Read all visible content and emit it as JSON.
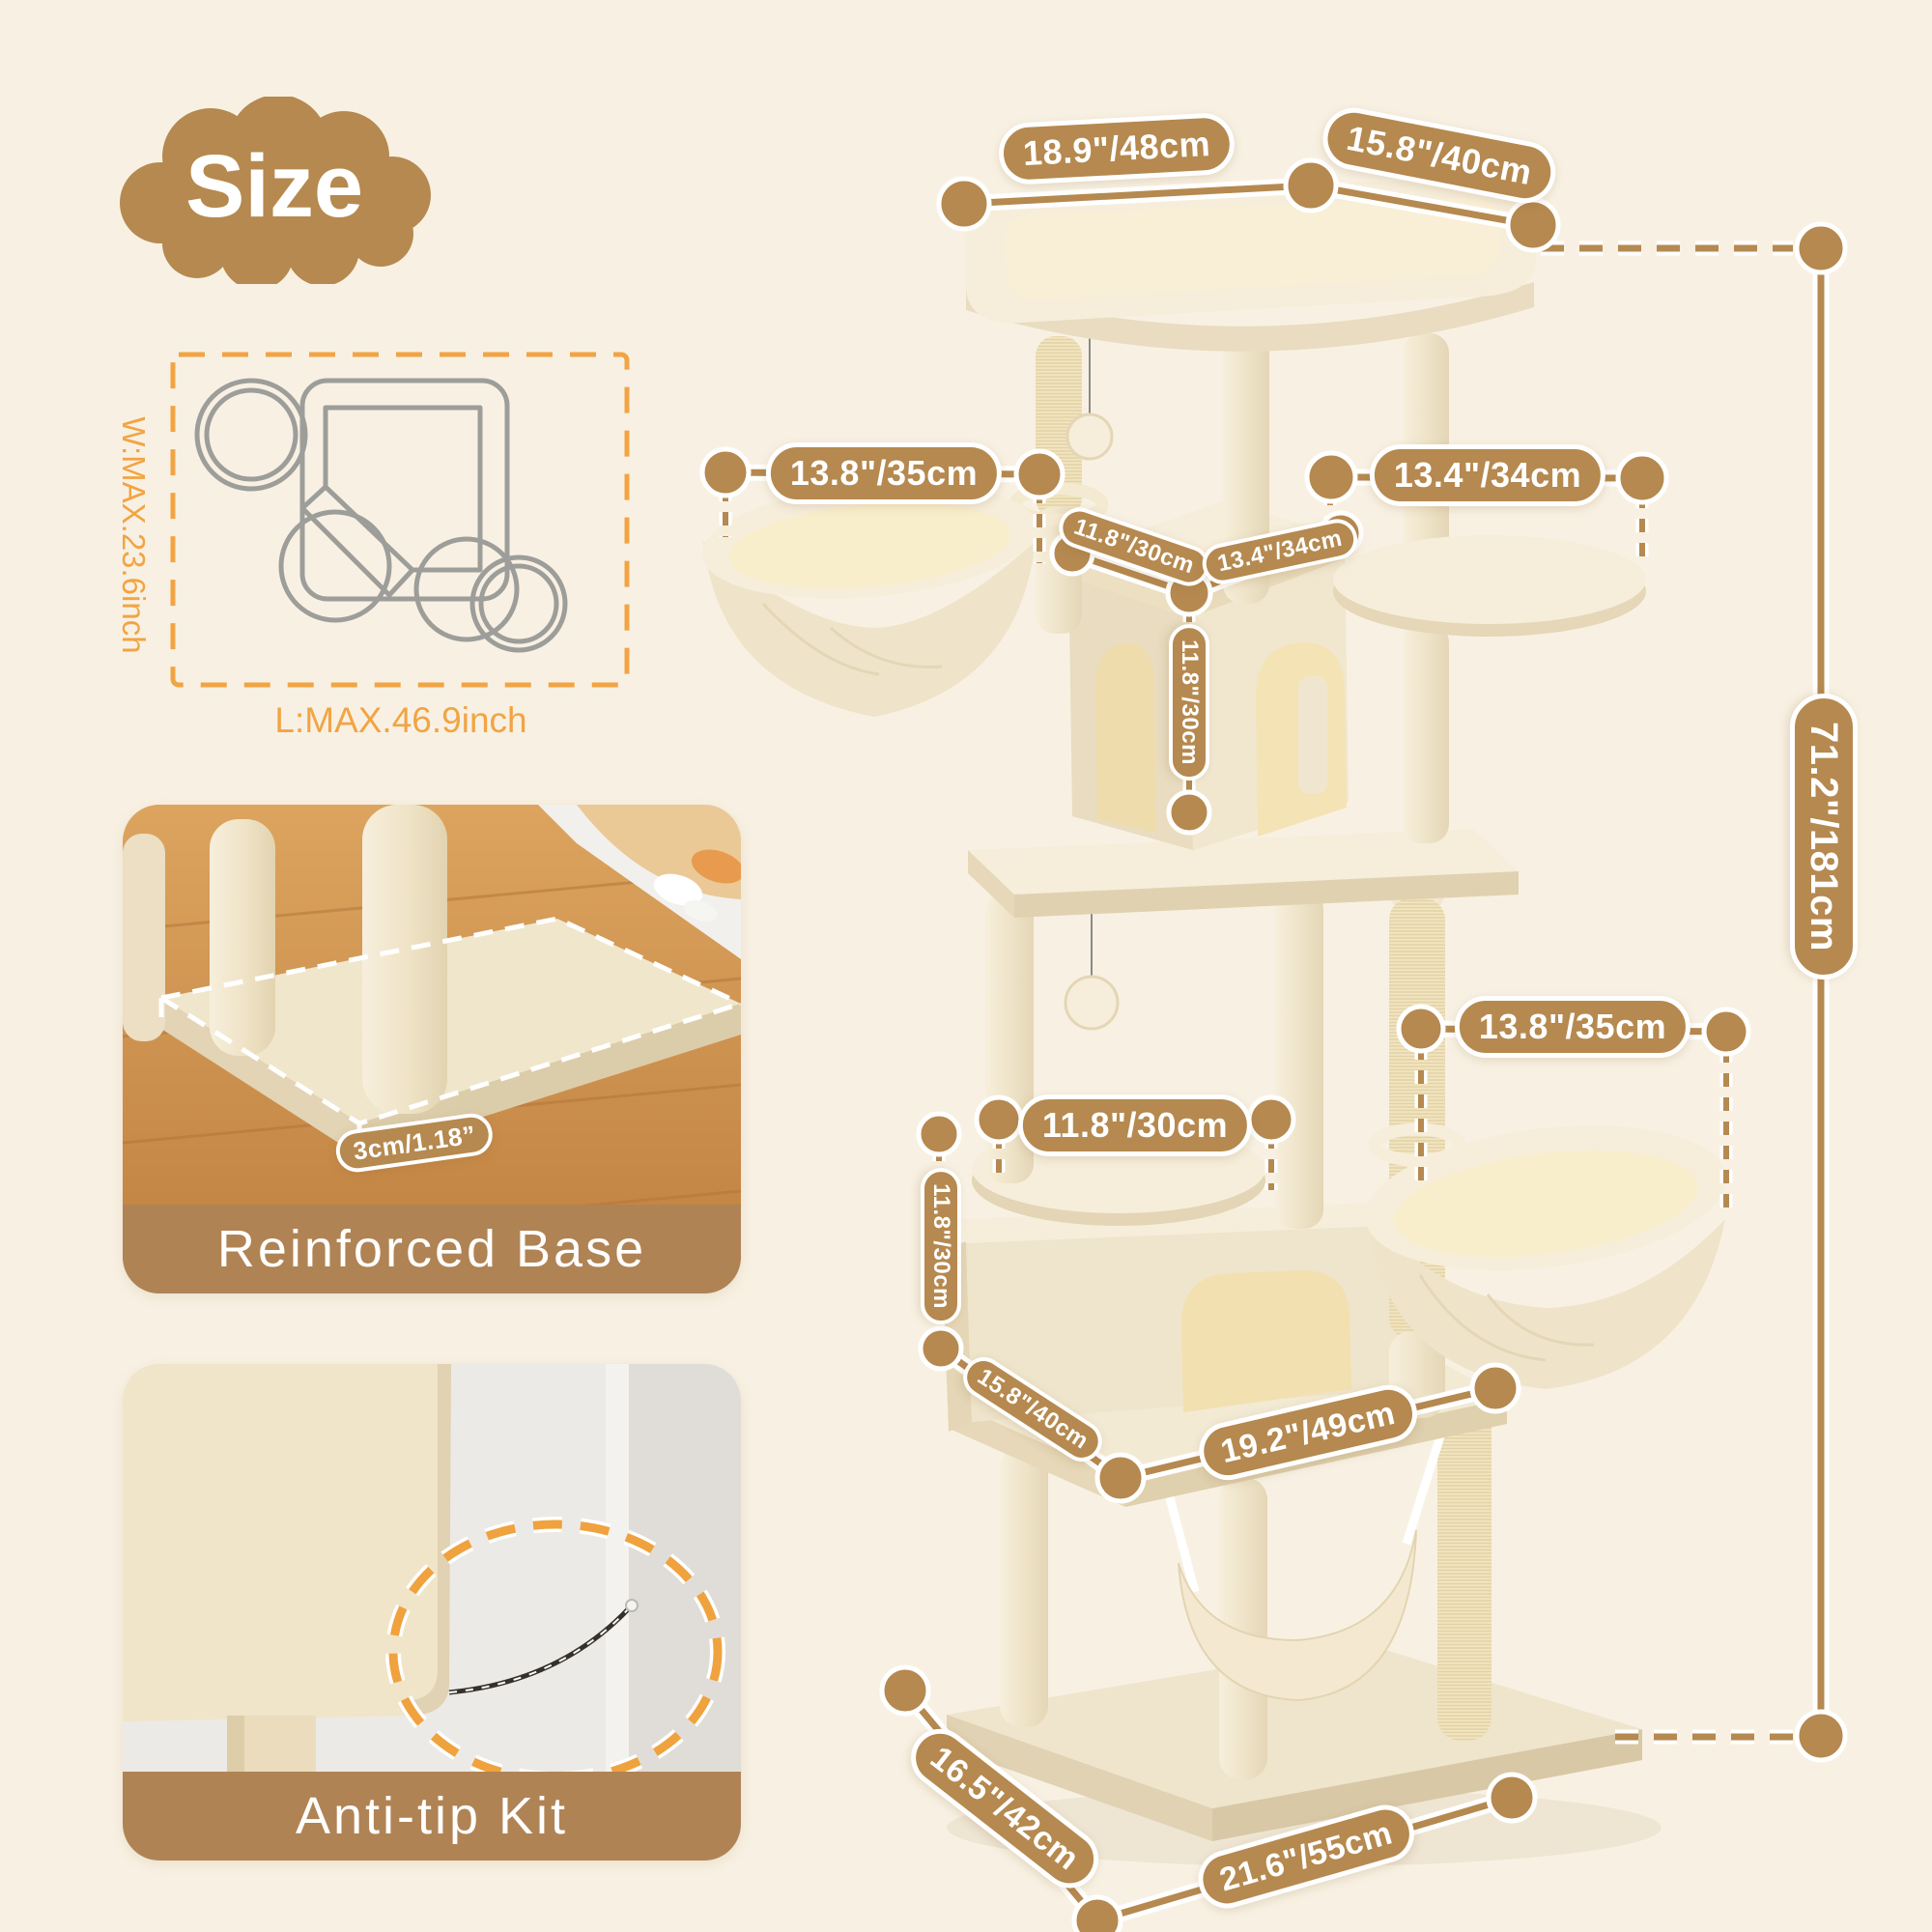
{
  "title": {
    "text": "Size"
  },
  "footprint": {
    "width_max": "W:MAX.23.6inch",
    "length_max": "L:MAX.46.9inch"
  },
  "cards": {
    "reinforced_base": {
      "caption": "Reinforced Base",
      "thickness": "3cm/1.18”"
    },
    "anti_tip": {
      "caption": "Anti-tip Kit"
    }
  },
  "dims": {
    "top_width": "18.9\"/48cm",
    "top_depth": "15.8\"/40cm",
    "upper_basket": "13.8\"/35cm",
    "upper_house_depth": "11.8\"/30cm",
    "upper_house_width": "13.4\"/34cm",
    "upper_house_height": "11.8\"/30cm",
    "upper_platform": "13.4\"/34cm",
    "total_height": "71.2\"/181cm",
    "mid_platform": "11.8\"/30cm",
    "lower_basket": "13.8\"/35cm",
    "lower_house_height": "11.8\"/30cm",
    "lower_platform": "15.8\"/40cm",
    "hammock_width": "19.2\"/49cm",
    "base_depth": "16.5\"/42cm",
    "base_width": "21.6\"/55cm"
  },
  "colors": {
    "background": "#f8f1e3",
    "accent_brown": "#b5894f",
    "accent_orange": "#f2a444",
    "caption_band": "#b08354"
  }
}
